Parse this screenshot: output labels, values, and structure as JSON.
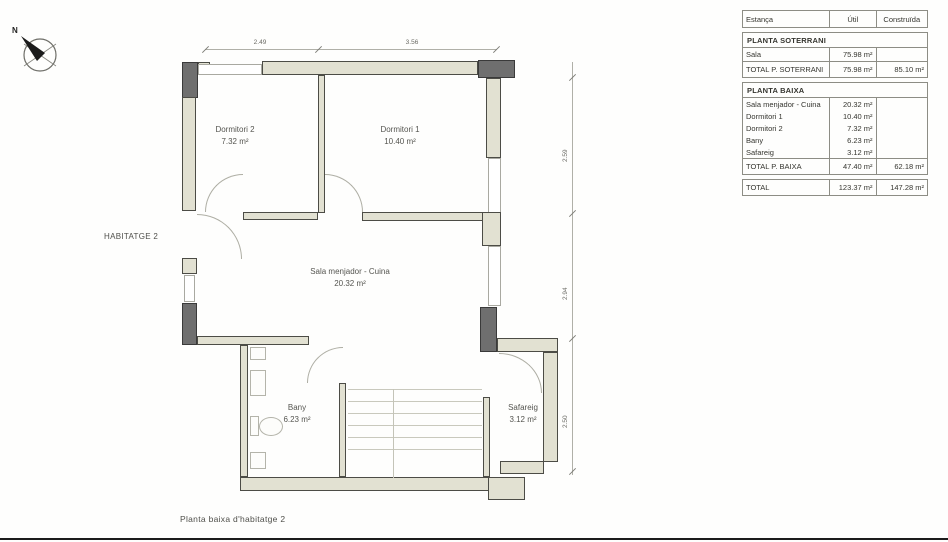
{
  "compass": {
    "north_label": "N"
  },
  "plan": {
    "unit_label": "HABITATGE 2",
    "caption": "Planta baixa d'habitatge 2",
    "rooms": [
      {
        "name": "Dormitori 2",
        "area": "7.32 m²"
      },
      {
        "name": "Dormitori 1",
        "area": "10.40 m²"
      },
      {
        "name": "Sala menjador - Cuina",
        "area": "20.32 m²"
      },
      {
        "name": "Bany",
        "area": "6.23 m²"
      },
      {
        "name": "Safareig",
        "area": "3.12 m²"
      }
    ],
    "dimensions": {
      "top": [
        "2.49",
        "3.56"
      ],
      "right": [
        "2.59",
        "2.94",
        "2.50"
      ]
    }
  },
  "table": {
    "headers": [
      "Estança",
      "Útil",
      "Construïda"
    ],
    "soterrani": {
      "title": "PLANTA SOTERRANI",
      "rows": [
        {
          "label": "Sala",
          "util": "75.98 m²",
          "constr": ""
        }
      ],
      "total": {
        "label": "TOTAL P. SOTERRANI",
        "util": "75.98 m²",
        "constr": "85.10 m²"
      }
    },
    "baixa": {
      "title": "PLANTA BAIXA",
      "rows": [
        {
          "label": "Sala menjador - Cuina",
          "util": "20.32 m²",
          "constr": ""
        },
        {
          "label": "Dormitori 1",
          "util": "10.40 m²",
          "constr": ""
        },
        {
          "label": "Dormitori 2",
          "util": "7.32 m²",
          "constr": ""
        },
        {
          "label": "Bany",
          "util": "6.23 m²",
          "constr": ""
        },
        {
          "label": "Safareig",
          "util": "3.12 m²",
          "constr": ""
        }
      ],
      "total": {
        "label": "TOTAL P. BAIXA",
        "util": "47.40 m²",
        "constr": "62.18 m²"
      }
    },
    "grand_total": {
      "label": "TOTAL",
      "util": "123.37 m²",
      "constr": "147.28 m²"
    }
  },
  "colors": {
    "wall_fill": "#e2e1d2",
    "column_fill": "#6f6f6f",
    "line": "#4c4c46"
  }
}
